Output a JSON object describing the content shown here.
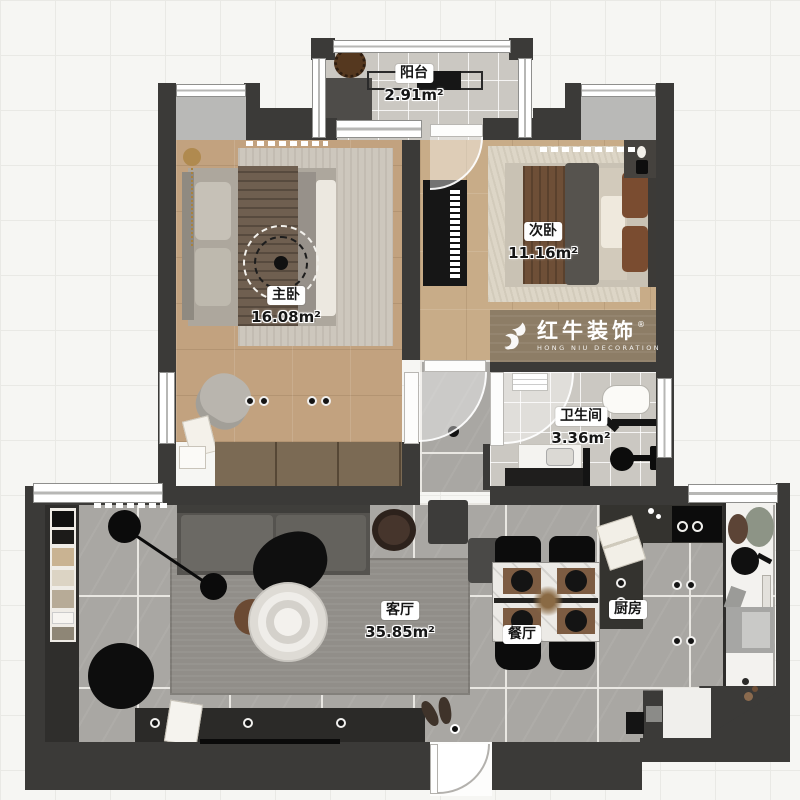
{
  "rooms": {
    "balcony": {
      "name": "阳台",
      "area": "2.91m²"
    },
    "master": {
      "name": "主卧",
      "area": "16.08m²"
    },
    "second": {
      "name": "次卧",
      "area": "11.16m²"
    },
    "bathroom": {
      "name": "卫生间",
      "area": "3.36m²"
    },
    "living": {
      "name": "客厅",
      "area": "35.85m²"
    },
    "dining": {
      "name": "餐厅"
    },
    "kitchen": {
      "name": "厨房"
    }
  },
  "logo": {
    "brand": "红牛装饰",
    "subtitle": "HONG NIU DECORATION",
    "registered": "®"
  },
  "colors": {
    "wall": "#3b3a38",
    "wood_floor": "#c2a27f",
    "gray_tile": "#a9a7a3",
    "light_tile": "#cbc8c2",
    "logo_wood": "#8d7d66",
    "accent_black": "#141414"
  }
}
